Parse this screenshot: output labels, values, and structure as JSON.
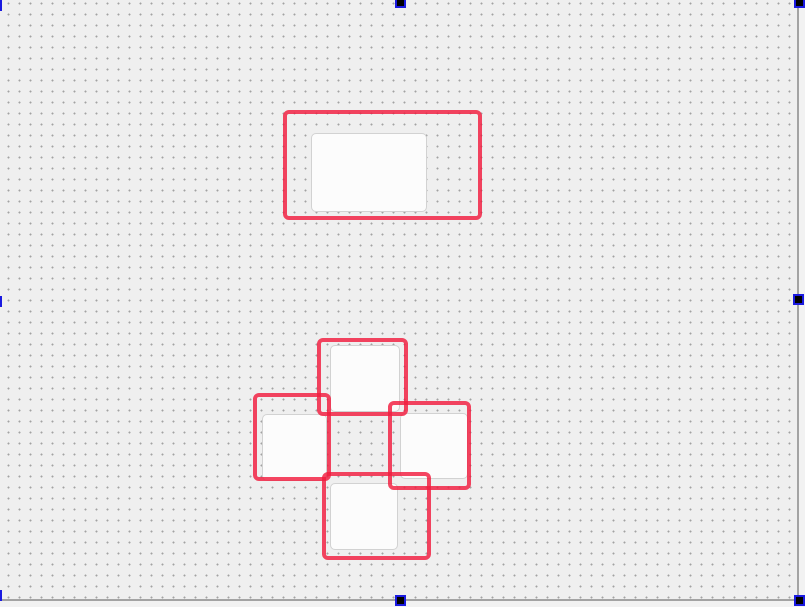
{
  "canvas": {
    "page_background": "#efefef",
    "outside_background": "#f2f2f2",
    "dot_color": "#a2a2a2",
    "dot_spacing_px": 11,
    "page_width": 799,
    "page_height": 601,
    "edge_line_color": "#a3a3a3"
  },
  "highlight_style": {
    "color": "rgba(242,28,62,0.82)",
    "border_width_px": 4,
    "corner_radius_px": 6
  },
  "node_style": {
    "fill": "#fcfcfc",
    "border_color": "#d2d2d2",
    "corner_radius_px": 5
  },
  "selection_style": {
    "handle_fill": "#000000",
    "handle_border": "#1a1ae0",
    "handle_size_px": 11
  },
  "shapes": {
    "nodes": [
      {
        "id": "node-top-large",
        "x": 311,
        "y": 133,
        "w": 116,
        "h": 79
      },
      {
        "id": "node-cluster-top",
        "x": 330,
        "y": 345,
        "w": 70,
        "h": 67
      },
      {
        "id": "node-cluster-left",
        "x": 262,
        "y": 414,
        "w": 65,
        "h": 67
      },
      {
        "id": "node-cluster-right",
        "x": 400,
        "y": 413,
        "w": 68,
        "h": 66
      },
      {
        "id": "node-cluster-bottom",
        "x": 330,
        "y": 483,
        "w": 68,
        "h": 67
      }
    ],
    "highlights": [
      {
        "id": "highlight-top-large",
        "x": 283,
        "y": 110,
        "w": 199,
        "h": 110
      },
      {
        "id": "highlight-cluster-top",
        "x": 317,
        "y": 338,
        "w": 91,
        "h": 78
      },
      {
        "id": "highlight-cluster-left",
        "x": 253,
        "y": 393,
        "w": 78,
        "h": 88
      },
      {
        "id": "highlight-cluster-right",
        "x": 388,
        "y": 401,
        "w": 83,
        "h": 89
      },
      {
        "id": "highlight-cluster-bottom",
        "x": 322,
        "y": 472,
        "w": 109,
        "h": 88
      }
    ],
    "selection_handles": [
      {
        "id": "handle-top-left",
        "x": -9,
        "y": 0
      },
      {
        "id": "handle-top-center",
        "x": 395,
        "y": -3
      },
      {
        "id": "handle-top-right",
        "x": 794,
        "y": -3
      },
      {
        "id": "handle-middle-left",
        "x": -9,
        "y": 296
      },
      {
        "id": "handle-middle-right",
        "x": 793,
        "y": 294
      },
      {
        "id": "handle-bottom-left",
        "x": -9,
        "y": 590
      },
      {
        "id": "handle-bottom-center",
        "x": 395,
        "y": 595
      },
      {
        "id": "handle-bottom-right",
        "x": 794,
        "y": 595
      }
    ]
  }
}
